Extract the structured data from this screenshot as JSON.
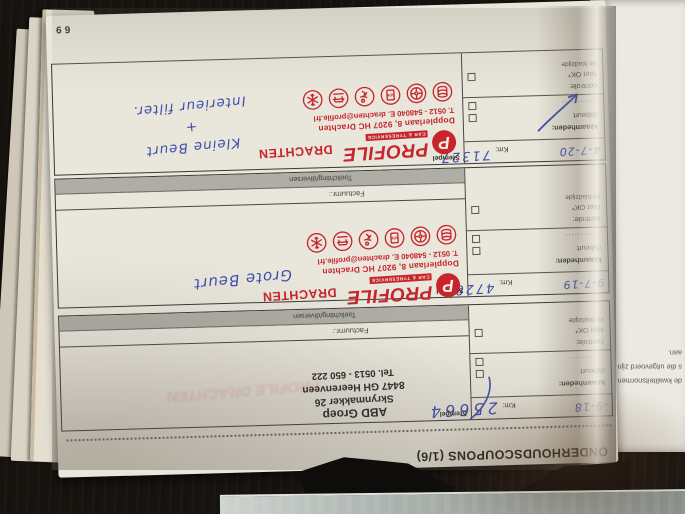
{
  "page": {
    "title": "ONDERHOUDSCOUPONS (1/6)",
    "number": "69"
  },
  "labels": {
    "stempel": "Stempel",
    "factuurnr": "Factuurnr.:",
    "toelichting": "Toelichting/diversen",
    "km": "Km:",
    "werkzaamheden": "kzaamheden:",
    "onderhoudsbeurt": "dsbeurt",
    "dotted_line": "............",
    "niveaucontrole": "controle:",
    "niet_ok": "Niet OK*",
    "bladzijde": "ke bladzijde"
  },
  "coupons": [
    {
      "date": "-9-18",
      "km": "25664"
    },
    {
      "date": "9-7-19",
      "km": "47288",
      "note": "Grote Beurt"
    },
    {
      "date": "4-7-20",
      "km": "71327",
      "note": [
        "Kleine Beurt",
        "+",
        "Interieur filter."
      ]
    }
  ],
  "profile_stamp": {
    "logo_letter": "P",
    "name": "PROFILE",
    "tagline": "CAR & TYRESERVICE",
    "city": "DRACHTEN",
    "address": "Dopplerlaan 8, 9207 HC Drachten",
    "contact": "T. 0512 - 548040   E. drachten@profile.frl",
    "icons": [
      "tyre-stack-icon",
      "wheel-icon",
      "apk-icon",
      "runner-icon",
      "car-lift-icon",
      "snowflake-icon"
    ]
  },
  "abd_stamp": {
    "lines": [
      "ABD Groep",
      "Skrynmakker 26",
      "8447 GH Heerenveen",
      "Tel. 0513 - 650 222"
    ]
  },
  "facing_page": {
    "lines": [
      "de kwaliteitsnormen als de c",
      "s die uitgevoerd zijn door e",
      "aan."
    ]
  },
  "colors": {
    "stamp_red": "#c8242c",
    "ink_blue": "#3d4fae",
    "paper": "#e9e6dc",
    "gray_bar": "#aeada6",
    "background": "#17130f"
  }
}
